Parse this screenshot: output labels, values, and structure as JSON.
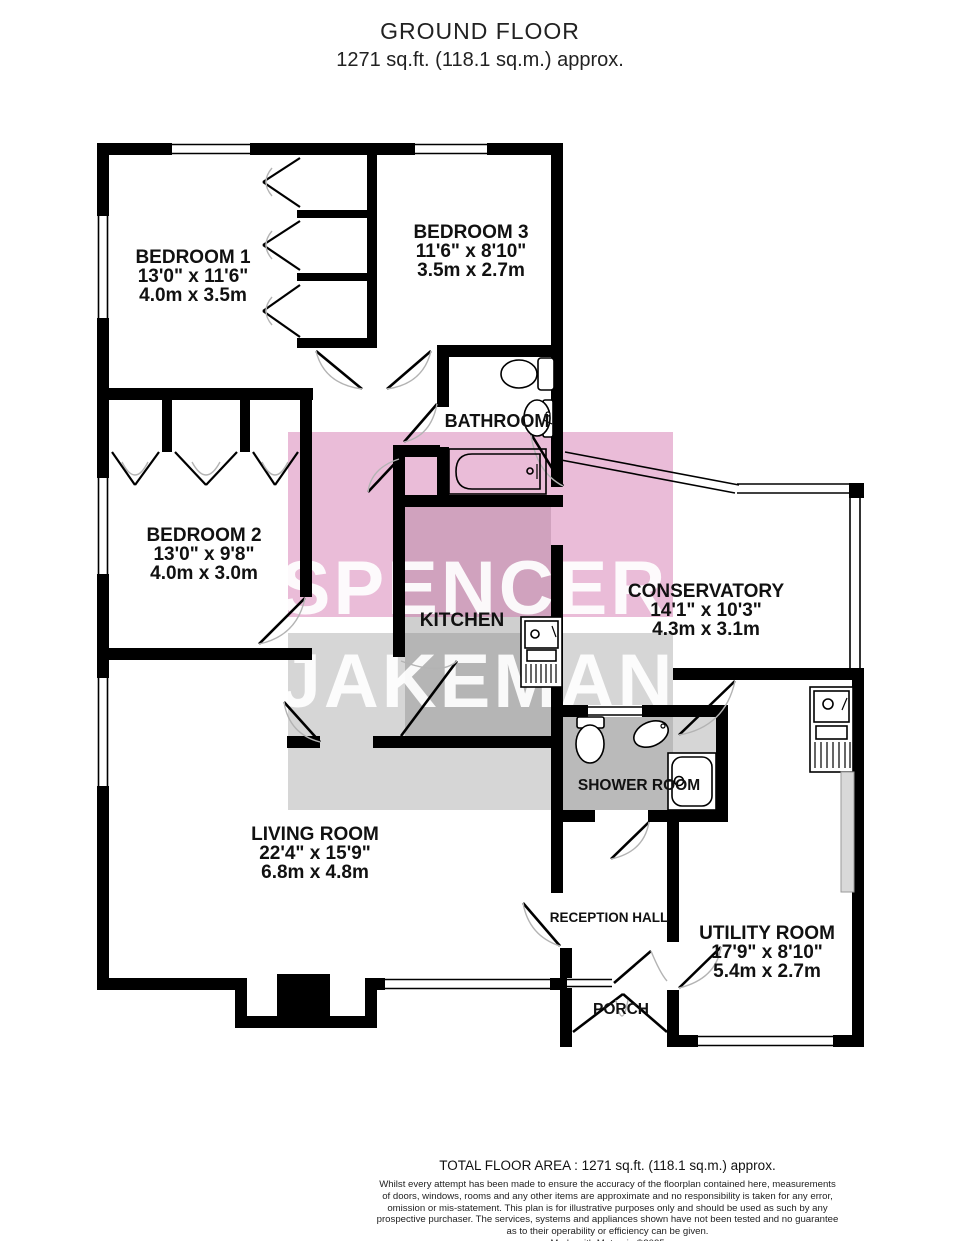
{
  "title": {
    "line1": "GROUND FLOOR",
    "line2": "1271 sq.ft. (118.1 sq.m.) approx."
  },
  "watermark": {
    "line1": "SPENCER",
    "line2": "JAKEMAN",
    "pink_fill": "#d06aa8",
    "gray_fill": "#808080"
  },
  "colors": {
    "wall": "#000000",
    "kitchen_floor": "#cfcfcf",
    "shower_floor": "#d6d6d6"
  },
  "rooms": {
    "bedroom1": {
      "name": "BEDROOM 1",
      "imperial": "13'0\"  x 11'6\"",
      "metric": "4.0m  x 3.5m"
    },
    "bedroom3": {
      "name": "BEDROOM 3",
      "imperial": "11'6\"  x 8'10\"",
      "metric": "3.5m  x 2.7m"
    },
    "bathroom": {
      "name": "BATHROOM"
    },
    "bedroom2": {
      "name": "BEDROOM 2",
      "imperial": "13'0\"  x 9'8\"",
      "metric": "4.0m  x 3.0m"
    },
    "kitchen": {
      "name": "KITCHEN"
    },
    "conservatory": {
      "name": "CONSERVATORY",
      "imperial": "14'1\"  x 10'3\"",
      "metric": "4.3m  x 3.1m"
    },
    "shower": {
      "name": "SHOWER ROOM"
    },
    "living": {
      "name": "LIVING ROOM",
      "imperial": "22'4\"  x 15'9\"",
      "metric": "6.8m  x 4.8m"
    },
    "reception": {
      "name": "RECEPTION HALL"
    },
    "utility": {
      "name": "UTILITY ROOM",
      "imperial": "17'9\"  x 8'10\"",
      "metric": "5.4m  x 2.7m"
    },
    "porch": {
      "name": "PORCH"
    }
  },
  "footer": {
    "total": "TOTAL FLOOR AREA : 1271 sq.ft. (118.1 sq.m.) approx.",
    "disclaimer_lines": [
      "Whilst every attempt has been made to ensure the accuracy of the floorplan contained here, measurements",
      "of doors, windows, rooms and any other items are approximate and no responsibility is taken for any error,",
      "omission or mis-statement. This plan is for illustrative purposes only and should be used as such by any",
      "prospective purchaser. The services, systems and appliances shown have not been tested and no guarantee",
      "as to their operability or efficiency can be given."
    ],
    "credit": "Made with Metropix ©2025"
  }
}
